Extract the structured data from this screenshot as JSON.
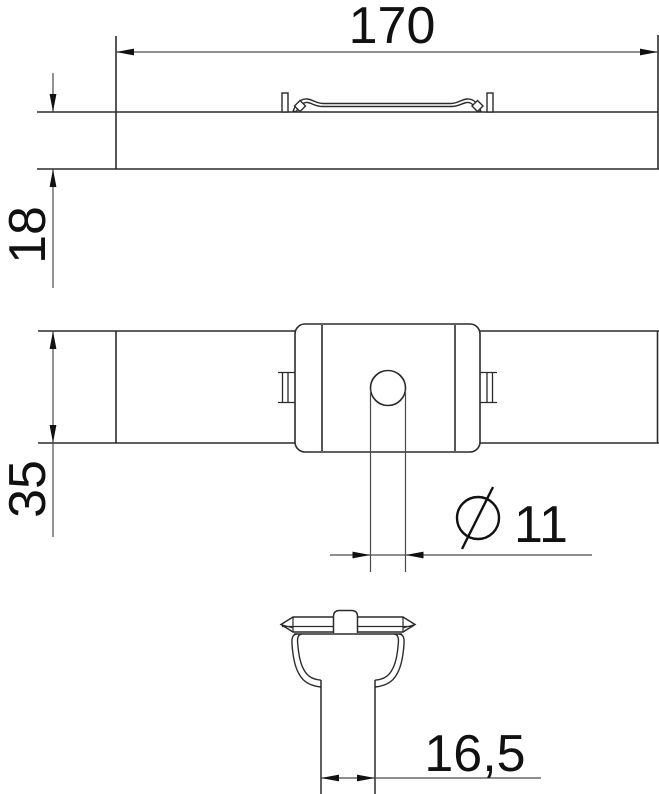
{
  "drawing": {
    "type": "engineering-dimension-drawing",
    "background": "#ffffff",
    "outline_color": "#2b2b2b",
    "dimension_color": "#4a4a4a",
    "text_color": "#111111",
    "views": {
      "side_view": "side elevation with spring clip",
      "top_view": "plan view with centre block and hole",
      "section_view": "cross section with stem"
    },
    "dimensions": {
      "length": {
        "value": "170"
      },
      "thickness": {
        "value": "18"
      },
      "width": {
        "value": "35"
      },
      "hole_diameter": {
        "value": "11",
        "symbol": "diameter-symbol"
      },
      "stem_width": {
        "value": "16,5"
      }
    }
  }
}
